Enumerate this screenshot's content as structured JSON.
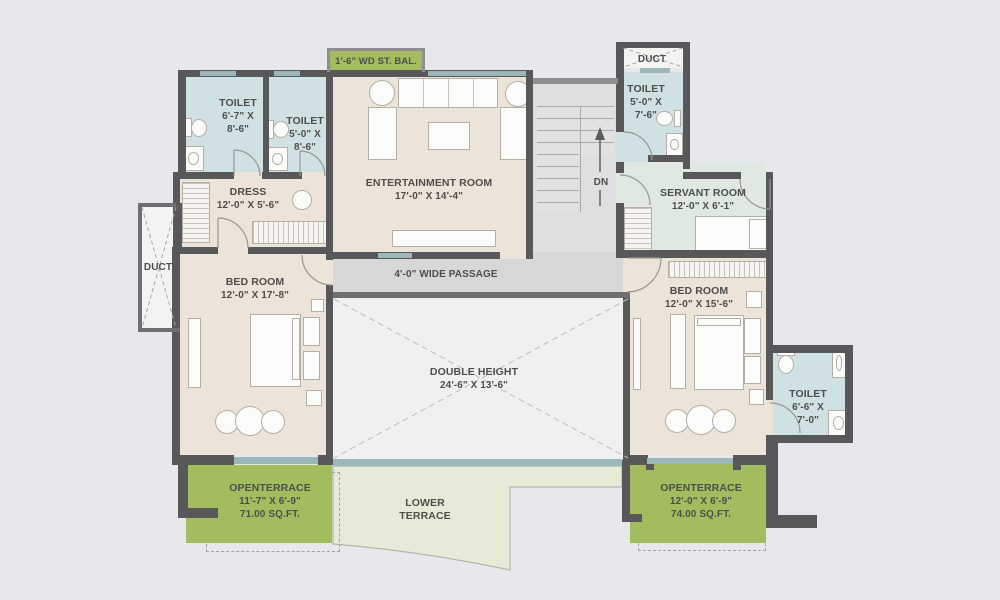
{
  "plan": {
    "type": "residential floor plan",
    "rooms": {
      "toilet_top_left_1": {
        "name": "TOILET",
        "dim_line1": "6'-7\" X",
        "dim_line2": "8'-6\""
      },
      "toilet_top_left_2": {
        "name": "TOILET",
        "dim_line1": "5'-0\" X",
        "dim_line2": "8'-6\""
      },
      "wardrobe_balcony": {
        "name": "1'-6\" WD ST. BAL."
      },
      "entertainment_room": {
        "name": "ENTERTAINMENT ROOM",
        "dim": "17'-0\" X 14'-4\""
      },
      "duct_top_right": {
        "name": "DUCT"
      },
      "toilet_top_right": {
        "name": "TOILET",
        "dim_line1": "5'-0\" X",
        "dim_line2": "7'-6\""
      },
      "stairs": {
        "direction_label": "DN"
      },
      "servant_room": {
        "name": "SERVANT ROOM",
        "dim": "12'-0\" X 6'-1\""
      },
      "dress": {
        "name": "DRESS",
        "dim": "12'-0\" X 5'-6\""
      },
      "duct_left": {
        "name": "DUCT"
      },
      "bedroom_left": {
        "name": "BED ROOM",
        "dim": "12'-0\" X 17'-8\""
      },
      "passage": {
        "name": "4'-0\" WIDE PASSAGE"
      },
      "double_height": {
        "name": "DOUBLE HEIGHT",
        "dim": "24'-6\" X 13'-6\""
      },
      "bedroom_right": {
        "name": "BED ROOM",
        "dim": "12'-0\" X 15'-6\""
      },
      "toilet_bottom_right": {
        "name": "TOILET",
        "dim_line1": "6'-6\" X",
        "dim_line2": "7'-0\""
      },
      "open_terrace_left": {
        "name": "OPENTERRACE",
        "dim": "11'-7\" X 6'-9\"",
        "area": "71.00 SQ.FT."
      },
      "lower_terrace": {
        "name_line1": "LOWER",
        "name_line2": "TERRACE"
      },
      "open_terrace_right": {
        "name": "OPENTERRACE",
        "dim": "12'-0\" X 6'-9\"",
        "area": "74.00 SQ.FT."
      }
    },
    "colors": {
      "background": "#e7e8ec",
      "wall": "#58585a",
      "room_beige": "#ece4d9",
      "toilet_blue": "#cfe1e3",
      "servant_green": "#dfe9e1",
      "terrace_green": "#a3bd5e",
      "lower_terrace_green": "#e6ebd8",
      "passage_gray": "#d7d7d9",
      "double_height_gray": "#eef0f2",
      "window_teal": "#9cb7ba",
      "text": "#4e4e4c"
    }
  }
}
